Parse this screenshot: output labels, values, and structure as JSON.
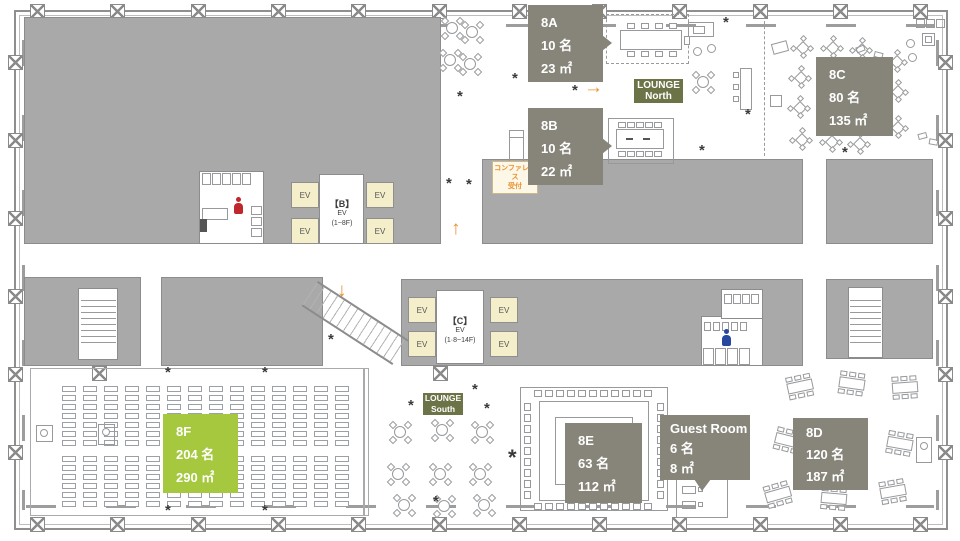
{
  "rooms": {
    "r8a": {
      "id": "8A",
      "capacity": "10 名",
      "area": "23 ㎡"
    },
    "r8b": {
      "id": "8B",
      "capacity": "10 名",
      "area": "22 ㎡"
    },
    "r8c": {
      "id": "8C",
      "capacity": "80 名",
      "area": "135 ㎡"
    },
    "r8d": {
      "id": "8D",
      "capacity": "120 名",
      "area": "187 ㎡"
    },
    "r8e": {
      "id": "8E",
      "capacity": "63 名",
      "area": "112 ㎡"
    },
    "r8f": {
      "id": "8F",
      "capacity": "204 名",
      "area": "290 ㎡"
    },
    "guest": {
      "id": "Guest Room",
      "capacity": "6 名",
      "area": "8 ㎡"
    }
  },
  "lounges": {
    "north": {
      "line1": "LOUNGE",
      "line2": "North"
    },
    "south": {
      "line1": "LOUNGE",
      "line2": "South"
    }
  },
  "elevators": {
    "cab_label": "EV",
    "bank_b": {
      "name": "【B】",
      "label": "EV",
      "floors": "(1~8F)"
    },
    "bank_c": {
      "name": "【C】",
      "label": "EV",
      "floors": "(1·8~14F)"
    }
  },
  "reception": {
    "line1": "コンファレンス",
    "line2": "受付"
  },
  "icons": {
    "arrow_right": "→",
    "arrow_up": "↑",
    "arrow_down": "↓"
  },
  "colors": {
    "room_label_bg": "#87857a",
    "highlight_room_bg": "#a5c83e",
    "lounge_bg": "#6b7347",
    "wall_fill": "#a9a9a9",
    "elevator_cab_bg": "#f4eecb",
    "accent_orange": "#e8922f"
  }
}
